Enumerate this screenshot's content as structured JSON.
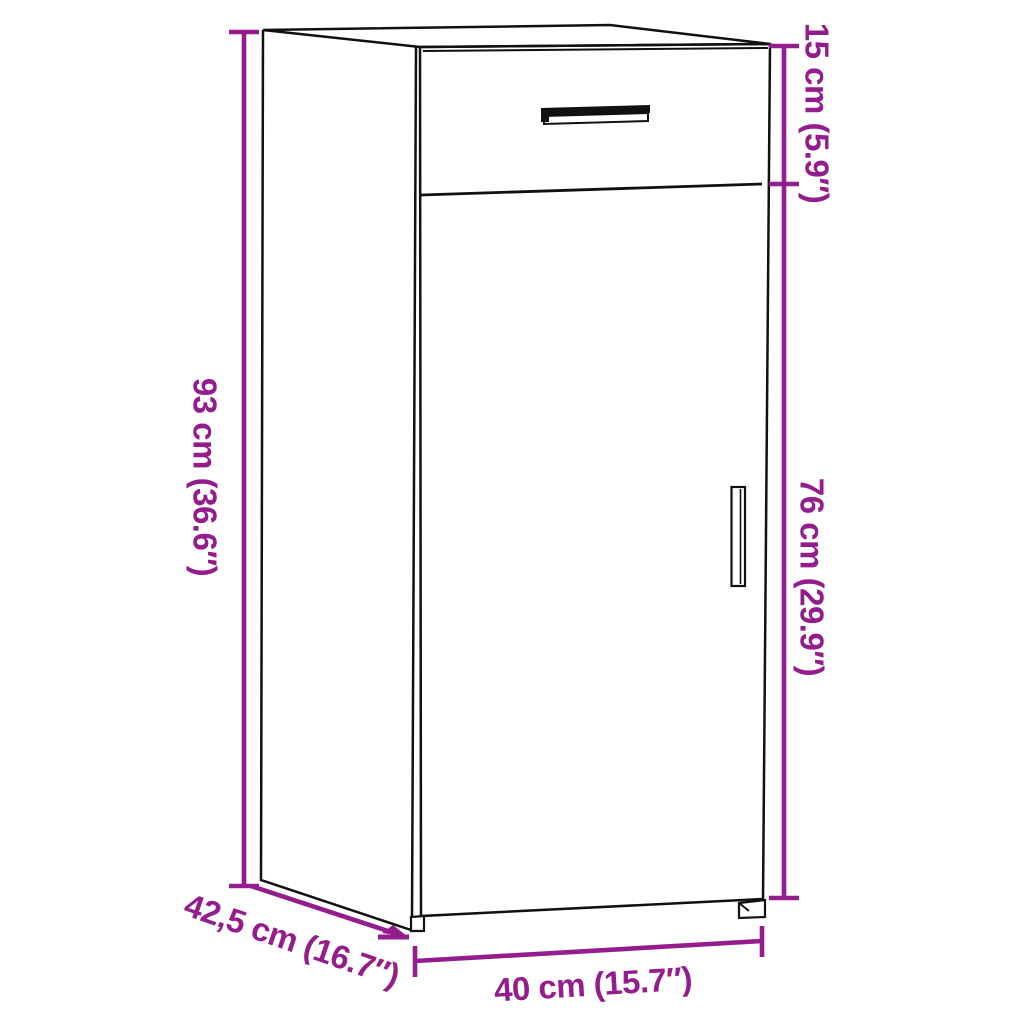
{
  "page": {
    "background": "#ffffff",
    "type": "product-dimension-diagram",
    "product": "storage cabinet with drawer and door"
  },
  "dimensions": {
    "overall_height": {
      "label": "93 cm (36.6″)",
      "cm": 93,
      "inches": 36.6
    },
    "drawer_section_height": {
      "label": "15 cm (5.9″)",
      "cm": 15,
      "inches": 5.9
    },
    "door_section_height": {
      "label": "76 cm (29.9″)",
      "cm": 76,
      "inches": 29.9
    },
    "depth": {
      "label": "42,5 cm (16.7″)",
      "cm": 42.5,
      "inches": 16.7
    },
    "width": {
      "label": "40 cm (15.7″)",
      "cm": 40,
      "inches": 15.7
    }
  },
  "colors": {
    "dimension_annotation": "#941C8C",
    "cabinet_outline": "#111111",
    "background": "#FFFFFF"
  }
}
